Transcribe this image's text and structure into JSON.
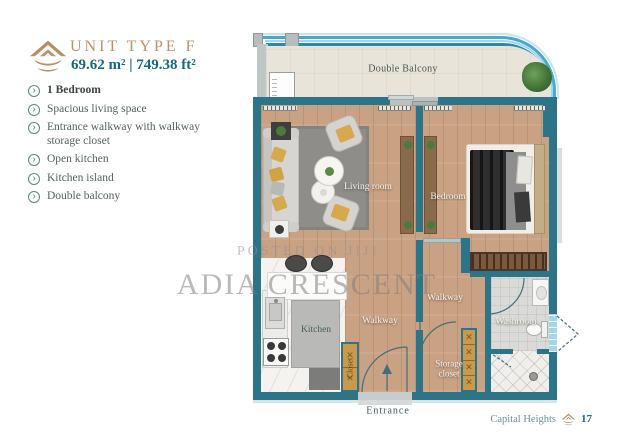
{
  "header": {
    "unit_title": "UNIT TYPE F",
    "area": "69.62 m² | 749.38 ft²"
  },
  "features": [
    {
      "label": "1 Bedroom"
    },
    {
      "label": "Spacious living space"
    },
    {
      "label": "Entrance walkway  with walkway storage closet"
    },
    {
      "label": "Open kitchen"
    },
    {
      "label": "Kitchen island"
    },
    {
      "label": "Double balcony"
    }
  ],
  "plan": {
    "rooms": {
      "double_balcony": "Double Balcony",
      "living_room": "Living room",
      "bedroom": "Bedroom",
      "kitchen": "Kitchen",
      "walkway_center": "Walkway",
      "walkway_right": "Walkway",
      "storage_closet": "Storage closet",
      "washroom": "Washroom",
      "closet": "Closet",
      "entrance": "Entrance"
    }
  },
  "watermark": {
    "line1": "POSTED ON JIJI",
    "line2": "ADIA CRESCENT"
  },
  "footer": {
    "brand": "Capital Heights",
    "page_number": "17"
  },
  "colors": {
    "gold": "#b5916b",
    "teal_text": "#15677e",
    "wall_teal": "#2c7488",
    "wood": "#c9a183",
    "railing_blue": "#2a89b0",
    "closet_orange": "#c99a4e",
    "watermark_gray": "#8a8a8a"
  }
}
